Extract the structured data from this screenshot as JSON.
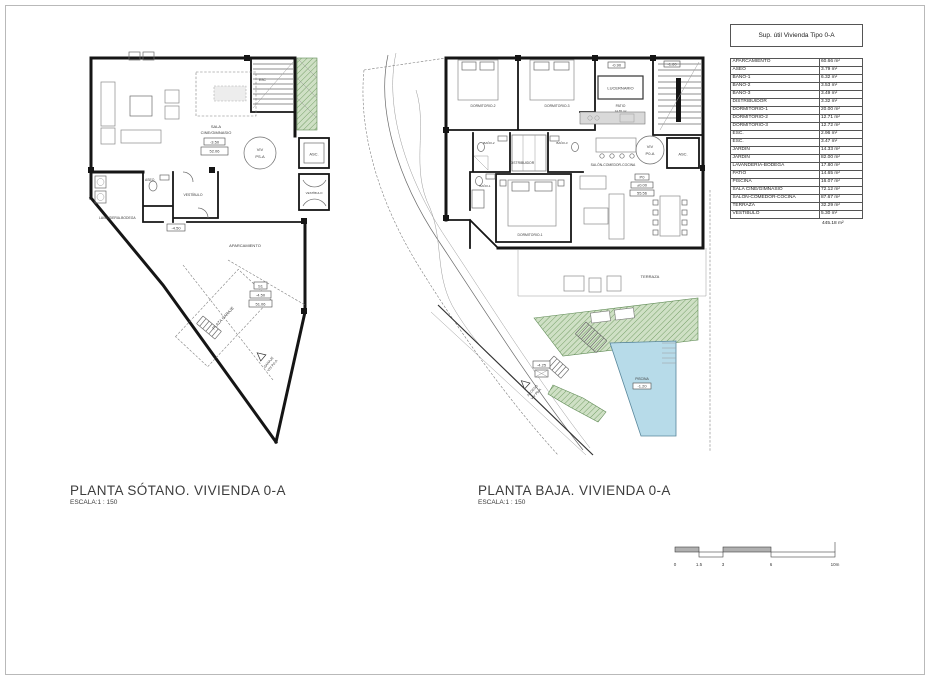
{
  "table": {
    "title": "Sup. útil Vivienda Tipo 0-A",
    "rows": [
      {
        "name": "APARCAMIENTO",
        "value": "60.66 m²"
      },
      {
        "name": "ASEO",
        "value": "3.79 m²"
      },
      {
        "name": "BAÑO-1",
        "value": "6.32 m²"
      },
      {
        "name": "BAÑO-2",
        "value": "3.53 m²"
      },
      {
        "name": "BAÑO-3",
        "value": "3.49 m²"
      },
      {
        "name": "DISTRIBUIDOR",
        "value": "3.32 m²"
      },
      {
        "name": "DORMITORIO-1",
        "value": "20.00 m²"
      },
      {
        "name": "DORMITORIO-2",
        "value": "12.71 m²"
      },
      {
        "name": "DORMITORIO-3",
        "value": "12.72 m²"
      },
      {
        "name": "ESC.",
        "value": "2.96 m²"
      },
      {
        "name": "ESC.",
        "value": "3.47 m²"
      },
      {
        "name": "JARDÍN",
        "value": "14.33 m²"
      },
      {
        "name": "JARDÍN",
        "value": "82.00 m²"
      },
      {
        "name": "LAVANDERIA-BODEGA",
        "value": "17.80 m²"
      },
      {
        "name": "PATIO",
        "value": "14.65 m²"
      },
      {
        "name": "PISCINA",
        "value": "16.07 m²"
      },
      {
        "name": "SALA CINE/GIMNASIO",
        "value": "72.12 m²"
      },
      {
        "name": "SALON-COMEDOR-COCINA",
        "value": "87.67 m²"
      },
      {
        "name": "TERRAZA",
        "value": "32.29 m²"
      },
      {
        "name": "VESTÍBULO",
        "value": "5.30 m²"
      }
    ],
    "total": "445.18 m²"
  },
  "plans": {
    "sotano": {
      "title": "PLANTA SÓTANO. VIVIENDA 0-A",
      "scale": "ESCALA:1 : 150",
      "labels": {
        "sala1": "SALA",
        "sala2": "CINE/GIMNASIO",
        "level": "-3.50",
        "elev": "52.06",
        "esc": "ESC",
        "viv1": "VIV",
        "viv2": "PS-A",
        "asc": "ASC.",
        "vest_core": "VESTÍBULO",
        "aseo": "ASEO",
        "vestibulo": "VESTÍBULO",
        "lavanderia": "LAVANDERIA-BODEGA",
        "aparcamiento": "APARCAMIENTO",
        "plaza": "PLAZA GARAJE",
        "s1": "S1",
        "s1_level": "-4.50",
        "s1_elev": "51.06",
        "entry_level": "-4.50",
        "garaje1": "GARAJE",
        "garaje2": "VIV P0-A"
      }
    },
    "baja": {
      "title": "PLANTA BAJA. VIVIENDA 0-A",
      "scale": "ESCALA:1 : 150",
      "labels": {
        "dorm2": "DORMITORIO-2",
        "dorm3": "DORMITORIO-3",
        "lucernario": "LUCERNARIO",
        "patio": "PATIO",
        "patio_area": "14.65 m²",
        "lvl_090": "-0.90",
        "lvl_160": "-1.60",
        "bano2": "BAÑO-2",
        "bano3": "BAÑO-3",
        "bano1": "BAÑO-1",
        "distribuidor": "DISTRIBUIDOR",
        "salon": "SALÓN-COMEDOR-COCINA",
        "viv1": "VIV",
        "viv2": "P0-A",
        "asc": "ASC.",
        "dorm1": "DORMITORIO-1",
        "p0": "P0",
        "lvl_000": "±0.00",
        "lvl_5556": "55.56",
        "terraza": "TERRAZA",
        "piscina": "PISCINA",
        "lvl_pool": "-1.20",
        "lvl_entry": "-4.25",
        "acceso1": "ACCESO",
        "acceso2": "VIV P0-A"
      }
    }
  },
  "scalebar": {
    "labels": [
      "0",
      "1.5",
      "3",
      "6",
      "10m"
    ]
  },
  "colors": {
    "wall": "#151515",
    "vegetation_fill": "#cfe0c5",
    "vegetation_hatch": "#76a068",
    "pool_fill": "#b7dbe9",
    "pool_stroke": "#58869b",
    "line_gray": "#6b6b6b",
    "frame_gray": "#b9b9b9"
  }
}
